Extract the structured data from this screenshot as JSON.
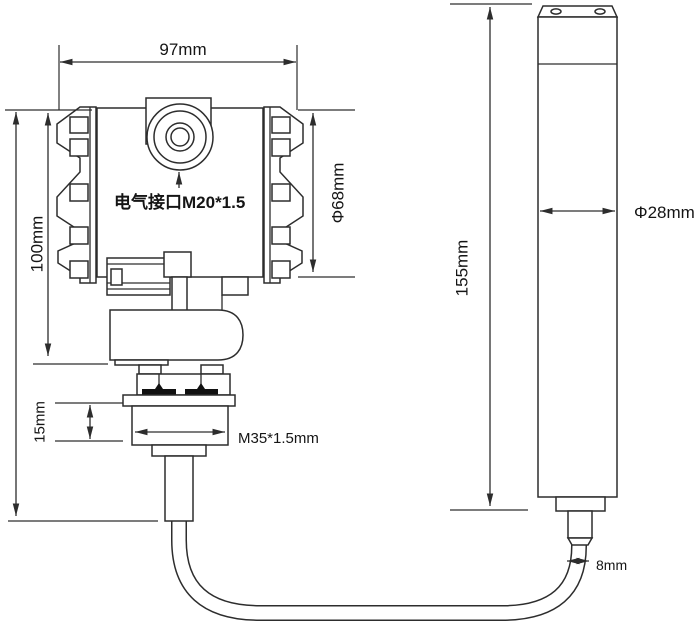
{
  "drawing": {
    "transmitter": {
      "width": "97mm",
      "body_height": "100mm",
      "body_diameter": "Φ68mm",
      "electrical_interface": "电气接口M20*1.5",
      "gland_height": "15mm",
      "mounting_thread": "M35*1.5mm"
    },
    "probe": {
      "length": "155mm",
      "diameter": "Φ28mm",
      "cable_diameter": "8mm"
    }
  }
}
